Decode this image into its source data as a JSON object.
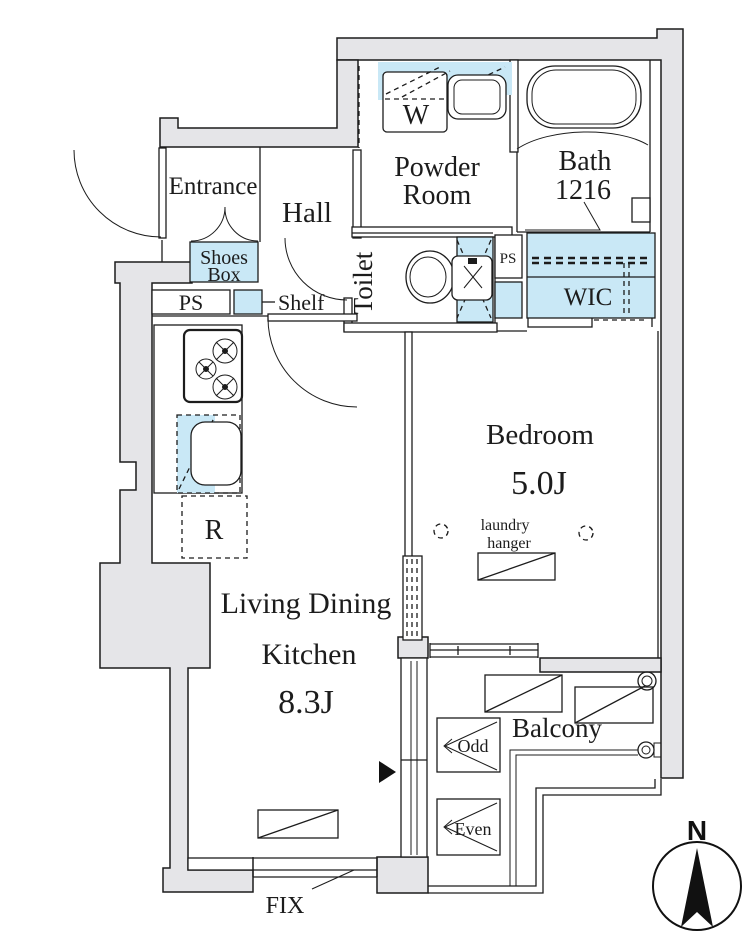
{
  "plan": {
    "rooms": {
      "entrance": "Entrance",
      "hall": "Hall",
      "powder_line1": "Powder",
      "powder_line2": "Room",
      "bath_line1": "Bath",
      "bath_line2": "1216",
      "toilet": "Toilet",
      "wic": "WIC",
      "bedroom_name": "Bedroom",
      "bedroom_size": "5.0J",
      "ldk_line1": "Living Dining",
      "ldk_line2": "Kitchen",
      "ldk_size": "8.3J",
      "balcony": "Balcony"
    },
    "fixtures": {
      "washer": "W",
      "shoes_line1": "Shoes",
      "shoes_line2": "Box",
      "ps_left": "PS",
      "ps_right": "PS",
      "shelf": "Shelf",
      "refrigerator": "R",
      "laundry_line1": "laundry",
      "laundry_line2": "hanger",
      "odd": "Odd",
      "even": "Even",
      "fix_window": "FIX"
    },
    "compass": {
      "north": "N"
    },
    "colors": {
      "wall_fill": "#e5e5e8",
      "fixture_blue": "#c9e8f6",
      "line": "#1c1c1c"
    }
  }
}
